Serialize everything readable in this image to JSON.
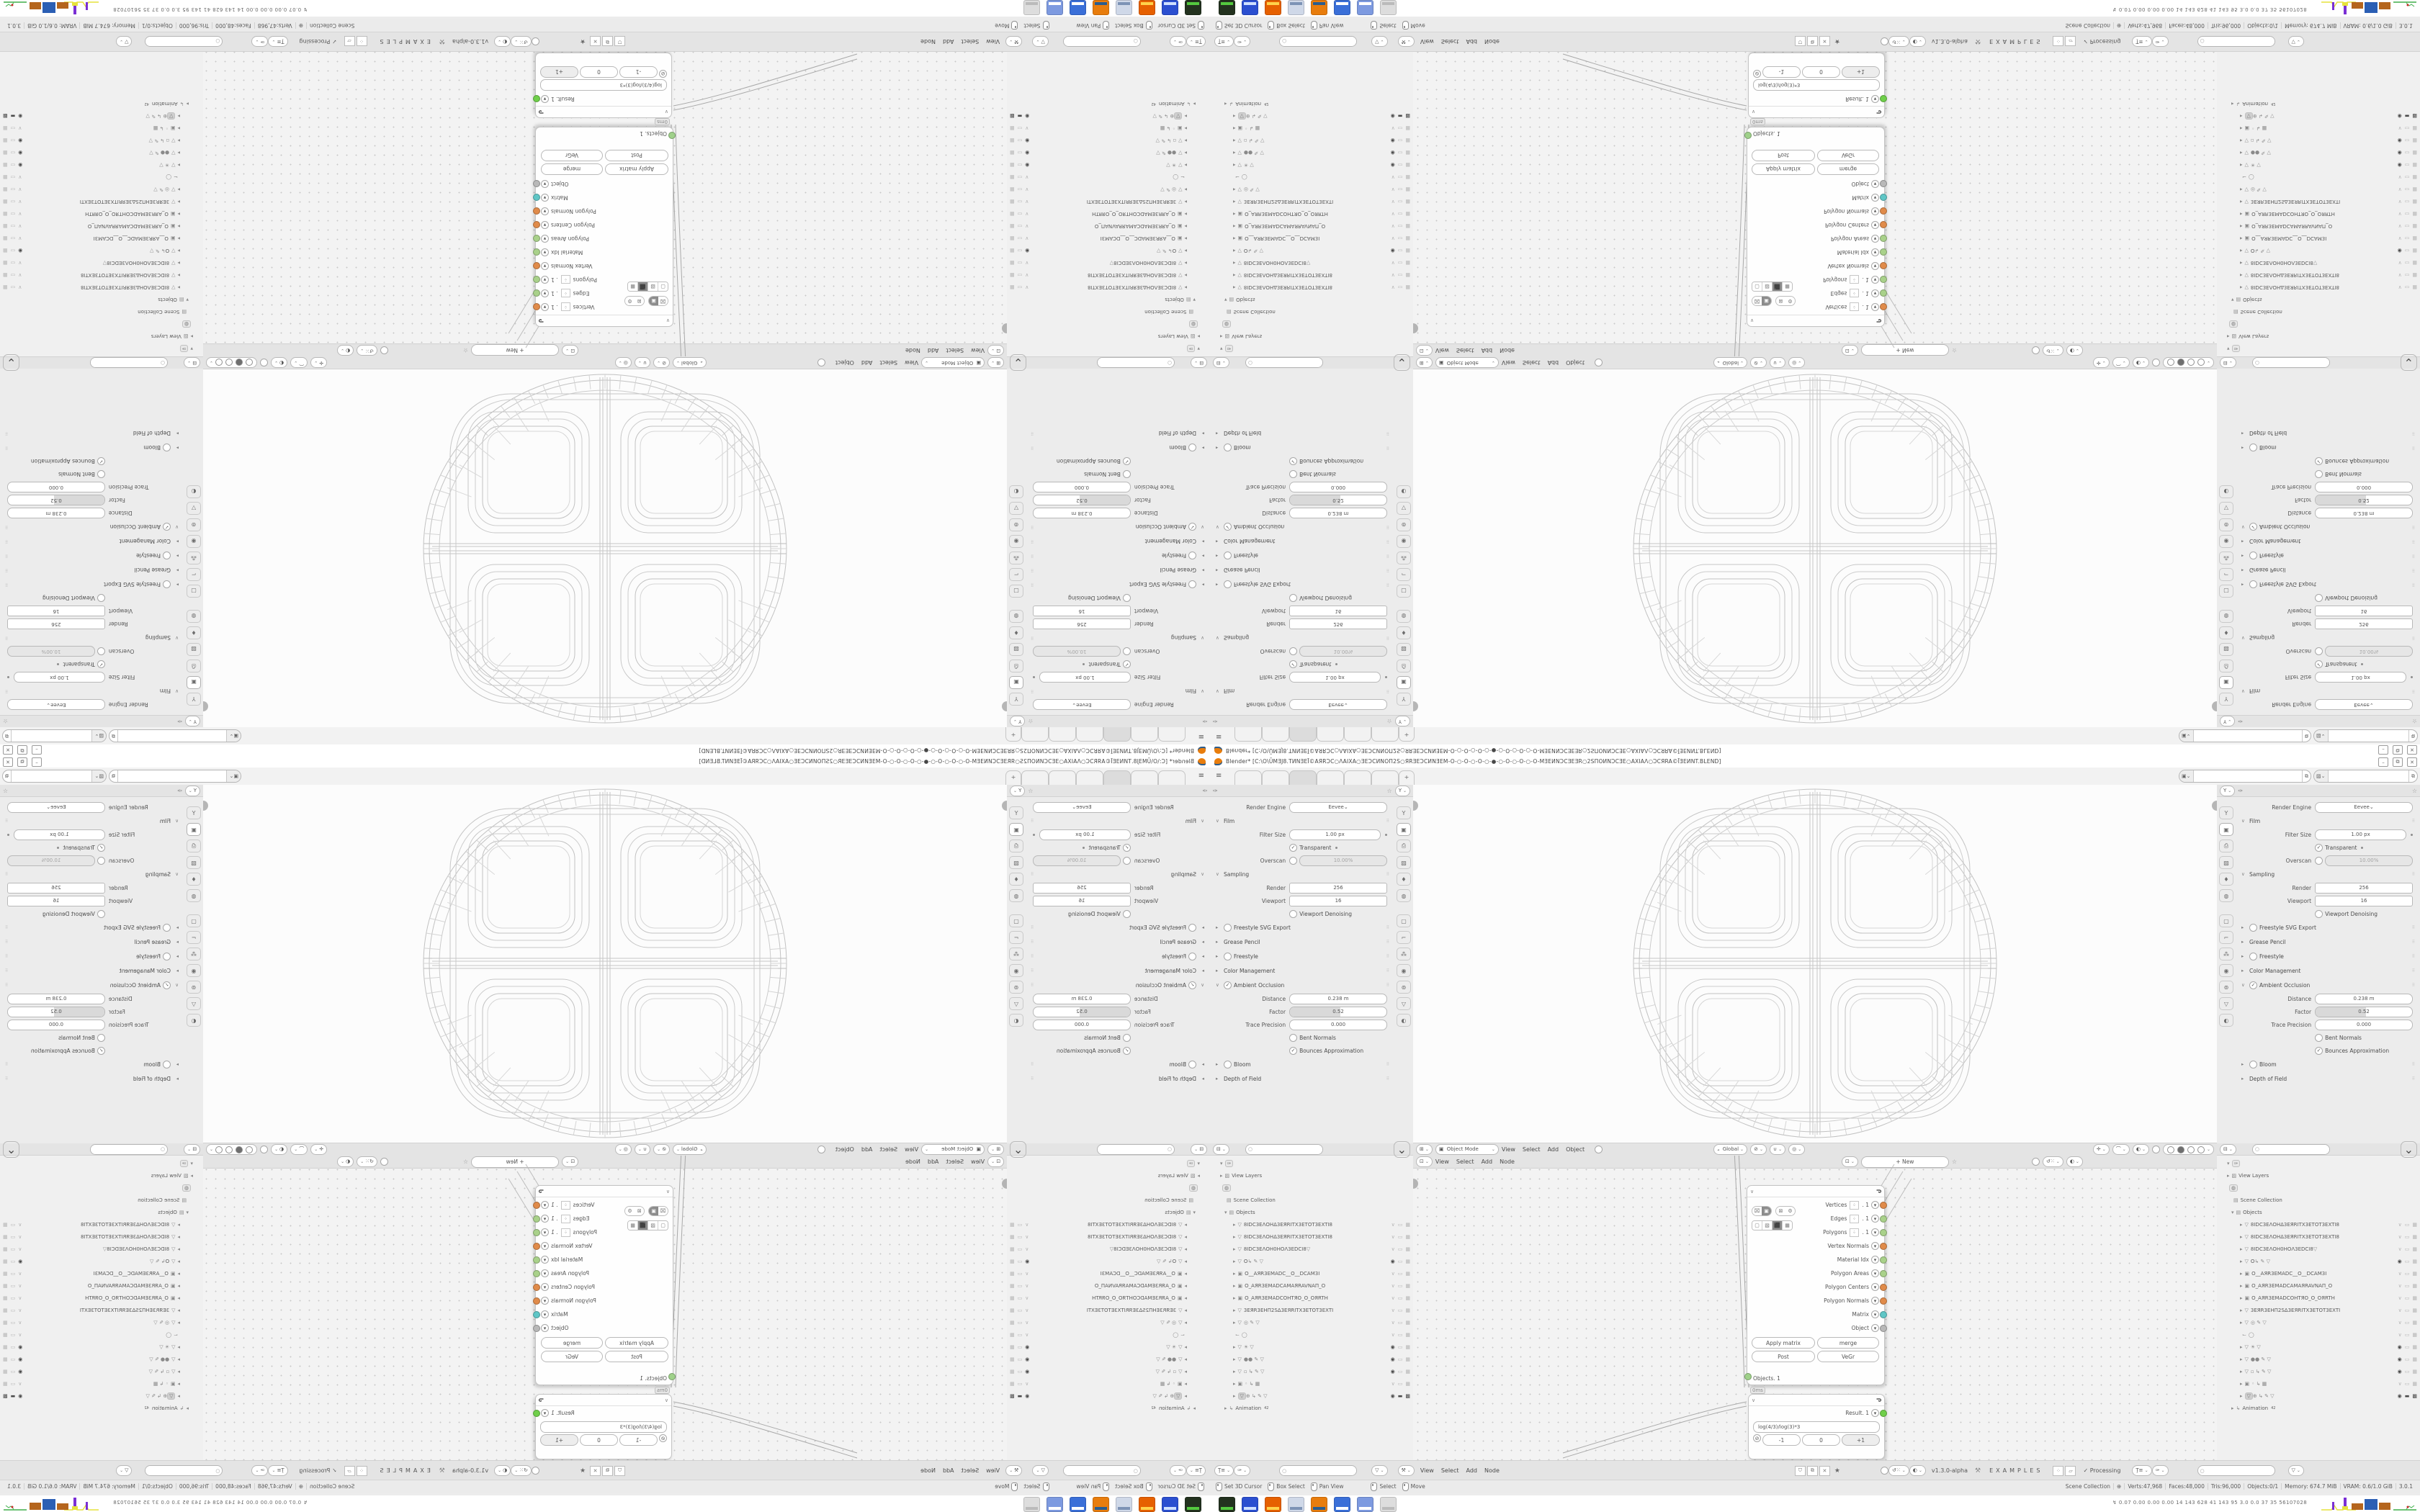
{
  "window": {
    "app": "Blender",
    "title": "Blender* [C:\\O\\ŪMƎJ8.TИNƎEĪ©AЯRƆC○ΛAIXA○ƎEƆCИNOΠ2S○ЯRƎEƆCИNƎEM-O-○-O-○-O-○-●-○-O-○-O-○-O-MƎEИNƆCƎEƎR○2SΠOИNƆCƎE○AXIAΛ○ƆCЯRA©ĪƎEИNT.BLEND]",
    "controls": [
      "–",
      "⧉",
      "✕"
    ]
  },
  "topbar": {
    "menu_icon": "≡",
    "workspace_tabs": {
      "count": 6,
      "active_index": 2,
      "add_label": "+"
    },
    "scene_selector": {
      "icon": "scene-icon",
      "value": "",
      "copy": "⧉"
    },
    "view_layer_selector": {
      "icon": "image-icon",
      "value": "",
      "copy": "⧉"
    }
  },
  "properties": {
    "pin_icon": "☆",
    "filter_icon": "Y",
    "tool_icon": "brush-icon",
    "nav_tabs": [
      "tool",
      "render",
      "output",
      "view-layer",
      "scene",
      "world",
      "object",
      "modifiers",
      "particles",
      "physics",
      "constraints",
      "data",
      "material"
    ],
    "nav_active_index": 1,
    "rows": [
      {
        "t": "engine",
        "label": "Render Engine",
        "value": "Eevee"
      },
      {
        "t": "sec",
        "label": "Film",
        "open": true
      },
      {
        "t": "field",
        "label": "Filter Size",
        "value": "1.00 px",
        "dot": true
      },
      {
        "t": "check",
        "label": "Transparent",
        "checked": true,
        "dot": true
      },
      {
        "t": "checkfield",
        "label": "Overscan",
        "checked": false,
        "value": "10.00%",
        "disabled": true
      },
      {
        "t": "sec",
        "label": "Sampling",
        "open": true
      },
      {
        "t": "field",
        "label": "Render",
        "value": "256",
        "boxy": true
      },
      {
        "t": "field",
        "label": "Viewport",
        "value": "16",
        "boxy": true
      },
      {
        "t": "check",
        "label": "Viewport Denoising",
        "checked": false
      },
      {
        "t": "sec",
        "label": "Freestyle SVG Export",
        "open": false,
        "cb": false
      },
      {
        "t": "sec",
        "label": "Grease Pencil",
        "open": false
      },
      {
        "t": "sec",
        "label": "Freestyle",
        "open": false,
        "cb": false
      },
      {
        "t": "sec",
        "label": "Color Management",
        "open": false
      },
      {
        "t": "sec",
        "label": "Ambient Occlusion",
        "open": true,
        "cb": true
      },
      {
        "t": "field",
        "label": "Distance",
        "value": "0.238 m"
      },
      {
        "t": "slider",
        "label": "Factor",
        "value": "0.52",
        "fill": 0.52
      },
      {
        "t": "field",
        "label": "Trace Precision",
        "value": "0.000"
      },
      {
        "t": "check",
        "label": "Bent Normals",
        "checked": false
      },
      {
        "t": "check",
        "label": "Bounces Approximation",
        "checked": true
      },
      {
        "t": "sec",
        "label": "Bloom",
        "open": false,
        "cb": false
      },
      {
        "t": "sec",
        "label": "Depth of Field",
        "open": false
      }
    ]
  },
  "viewport": {
    "mode": "Object Mode",
    "menus": [
      "View",
      "Select",
      "Add",
      "Object"
    ],
    "orientation": "Global",
    "shading_modes": [
      "wireframe",
      "solid",
      "material",
      "rendered"
    ],
    "shading_active": 1
  },
  "node_editor": {
    "menus": [
      "View",
      "Select",
      "Add",
      "Node"
    ],
    "tree_button": "New",
    "pin_icon": "☆",
    "version": "v1.3.0-alpha",
    "tree_name": "EXAMPLES",
    "processing": "Processing",
    "side_buttons": [
      "shield",
      "copy",
      "close"
    ],
    "node1": {
      "title": "",
      "outputs": [
        {
          "label": "Vertices",
          "chip": ". 1",
          "color": "#e08b4a"
        },
        {
          "label": "Edges",
          "chip": ". 1",
          "color": "#a9d18a"
        },
        {
          "label": "Polygons",
          "chip": ". 1",
          "color": "#a9d18a"
        },
        {
          "label": "Vertex Normals",
          "chip": null,
          "color": "#e08b4a"
        },
        {
          "label": "Material Idx",
          "chip": null,
          "color": "#a9d18a"
        },
        {
          "label": "Polygon Areas",
          "chip": null,
          "color": "#a9d18a"
        },
        {
          "label": "Polygon Centers",
          "chip": null,
          "color": "#e08b4a"
        },
        {
          "label": "Polygon Normals",
          "chip": null,
          "color": "#e08b4a"
        },
        {
          "label": "Matrix",
          "chip": null,
          "color": "#5fc6c6"
        },
        {
          "label": "Object",
          "chip": null,
          "color": "#b8b8b8"
        }
      ],
      "toggle_chips": [
        "mesh-x",
        "camera",
        "origin-x",
        "gears"
      ],
      "mode_boxes": [
        "plain",
        "wire-cube",
        "solid-cube",
        "checker"
      ],
      "buttons": [
        "Apply matrix",
        "merge",
        "Post",
        "VeGr"
      ],
      "input_label": "Objects. 1",
      "timing_tag": "0ms"
    },
    "node2": {
      "output_label": "Result. 1",
      "formula": "log(4/3)/log(3)*3",
      "stepper": [
        "-1",
        "0",
        "+1"
      ],
      "socket_color": "#6fcf4a"
    }
  },
  "outliner": {
    "search_placeholder": "",
    "rows": [
      {
        "arrow": "▾",
        "icon": "brush-chip",
        "label": "",
        "right": []
      },
      {
        "arrow": "▸",
        "icon": "image",
        "label": "View Layers",
        "chip_after": "image",
        "right": []
      },
      {
        "arrow": "",
        "icon": "world-chip",
        "label": "",
        "right": []
      },
      {
        "arrow": "",
        "icon": "collection",
        "label": "Scene Collection",
        "right": []
      },
      {
        "arrow": "▾",
        "icon": "collection",
        "label": "Objects",
        "right": []
      },
      {
        "arrow": "▸",
        "icon": "mesh",
        "label": "8IDC3EΛOHΔ3EЯRITX3ETOT3EXTI8",
        "right": [
          "closed",
          "screen",
          "camera"
        ]
      },
      {
        "arrow": "▸",
        "icon": "mesh",
        "label": "8IDC3EΛOHΔ3EЯRITX3ETOT3EXTI8",
        "right": [
          "closed",
          "screen",
          "camera"
        ]
      },
      {
        "arrow": "▸",
        "icon": "mesh",
        "label": "8IDC3EΛOH0HOΛ3EDCI8",
        "extra": "▽",
        "right": [
          "closed",
          "screen",
          "camera"
        ]
      },
      {
        "arrow": "▸",
        "icon": "mesh",
        "label": "O",
        "extra": "↳ ✎ ▽",
        "right": [
          "open",
          "screen",
          "camera"
        ]
      },
      {
        "arrow": "▸",
        "icon": "camera-data",
        "label": "O__AЯR3EMADC__O__DCAM3I",
        "right": [
          "closed",
          "screen",
          "camera"
        ]
      },
      {
        "arrow": "▸",
        "icon": "camera-data",
        "label": "O_AЯR3EMADCAMAЯRAVNAΠ_O",
        "right": [
          "closed",
          "screen",
          "camera"
        ]
      },
      {
        "arrow": "▸",
        "icon": "camera-data",
        "label": "O_AЯR3EMADCOHTЯO_O_OЯRTH",
        "right": [
          "closed",
          "screen",
          "camera"
        ]
      },
      {
        "arrow": "▸",
        "icon": "mesh",
        "label": "3EЯR3EHΠ2SΔ3EЯRITX3ETOT3EXTI",
        "right": [
          "closed",
          "screen",
          "camera"
        ]
      },
      {
        "arrow": "▸",
        "icon": "mesh",
        "label": "",
        "extra": "◎  ✎ ▽",
        "right": [
          "closed",
          "screen",
          "camera"
        ]
      },
      {
        "arrow": "",
        "icon": "foot",
        "label": "",
        "extra": "◯",
        "right": [
          "closed",
          "screen",
          "camera"
        ]
      },
      {
        "arrow": "▸",
        "icon": "mesh",
        "label": "",
        "extra": "☀  ▽",
        "right": [
          "open",
          "screen",
          "camera"
        ]
      },
      {
        "arrow": "▸",
        "icon": "mesh",
        "label": "",
        "extra": "●●  ✎ ▽",
        "right": [
          "open",
          "screen",
          "camera"
        ]
      },
      {
        "arrow": "▸",
        "icon": "mesh",
        "label": "",
        "extra": "▫  ↳ ✎ ▽",
        "right": [
          "open",
          "screen",
          "camera"
        ]
      },
      {
        "arrow": "▸",
        "icon": "camera-data",
        "label": "",
        "extra": "◦  ↳ ▦",
        "right": [
          "closed",
          "screen",
          "camera"
        ]
      },
      {
        "arrow": "▸",
        "icon": "mesh-active",
        "label": "",
        "extra": "⊕  ↳ ✎ ▽",
        "right": [
          "open",
          "screen-on",
          "camera-on"
        ],
        "active": true
      },
      {
        "arrow": "▸",
        "icon": "anim",
        "label": "Animation",
        "sup": "42",
        "right": []
      }
    ]
  },
  "status_bar": {
    "hints": [
      {
        "icon": "mouse-left",
        "label": "Set 3D Cursor"
      },
      {
        "icon": "mouse-left-drag",
        "label": "Box Select"
      },
      {
        "icon": "mouse-mid",
        "label": "Pan View"
      },
      {
        "icon": "mouse-right",
        "label": "Select"
      },
      {
        "icon": "mouse-right-drag",
        "label": "Move"
      }
    ],
    "info": [
      "Scene Collection",
      "⊕",
      "Verts:47,968",
      "Faces:48,000",
      "Tris:96,000",
      "Objects:0/1",
      "Memory: 674.7 MiB",
      "VRAM: 0.6/1.0 GiB",
      "3.0.1"
    ]
  },
  "taskbar": {
    "apps": [
      {
        "name": "terminal",
        "color": "#23321f",
        "accent": "#54c93f"
      },
      {
        "name": "save-tool",
        "color": "#2b4fd0",
        "accent": "#cfe0ff"
      },
      {
        "name": "firefox",
        "color": "#e66000",
        "accent": "#ffd24a"
      },
      {
        "name": "notepad",
        "color": "#cfd8e8",
        "accent": "#7d93b5"
      },
      {
        "name": "blender",
        "color": "#e87d0d",
        "accent": "#2a5d8f"
      },
      {
        "name": "calculator",
        "color": "#3a6fd8",
        "accent": "#ffffff"
      },
      {
        "name": "calculator-2",
        "color": "#7d9ae0",
        "accent": "#ffffff"
      },
      {
        "name": "inactive-app",
        "color": "#dddddd",
        "accent": "#bbbbbb"
      }
    ],
    "monitor_stats": "0.07 0.00 0.00 0.00   14   143   628   41   143   95   3.0   0.0   37   35   56107028",
    "spark_colors": {
      "yellow": "#e6e23c",
      "purple": "#7a2fd4",
      "orange": "#b5651d",
      "blue": "#2b5fb4",
      "green": "#3fae49",
      "red": "#cc2b2b"
    }
  }
}
